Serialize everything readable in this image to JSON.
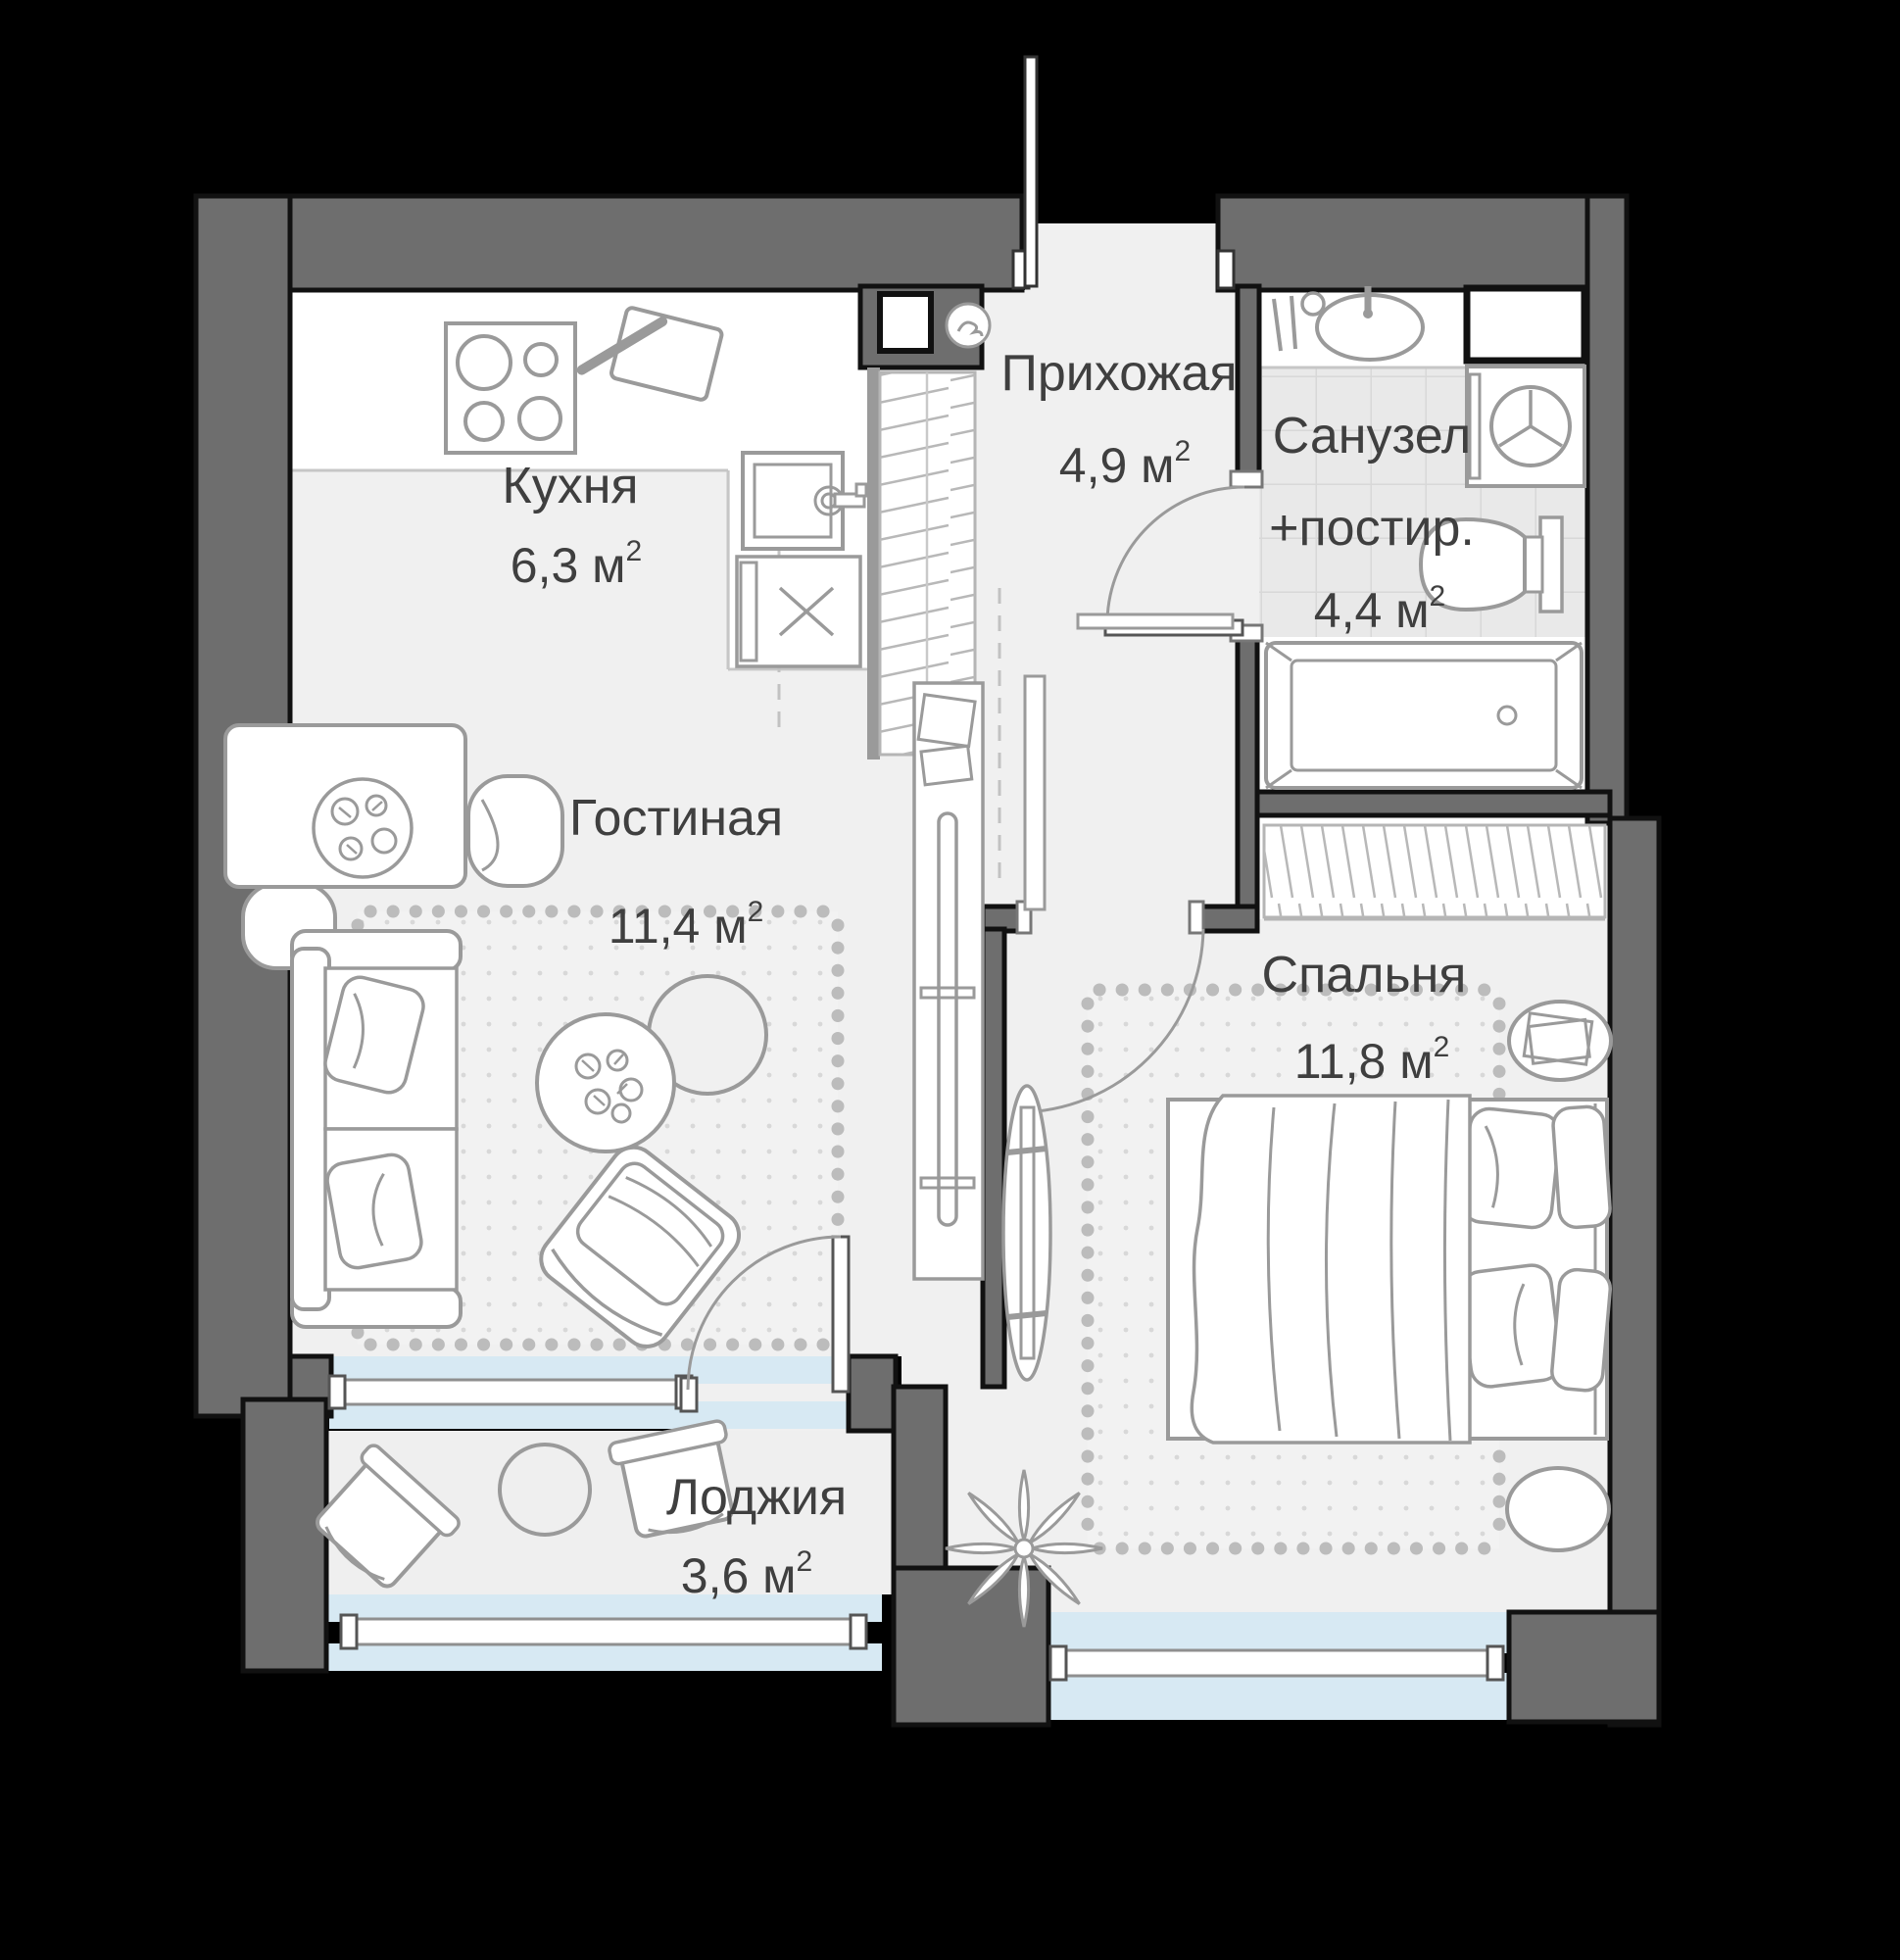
{
  "plan": {
    "title": "apartment-floor-plan",
    "language": "ru",
    "rooms": [
      {
        "id": "kitchen",
        "name": "Кухня",
        "area": "6,3 м",
        "sup": "2"
      },
      {
        "id": "hallway",
        "name": "Прихожая",
        "area": "4,9 м",
        "sup": "2"
      },
      {
        "id": "bathroom",
        "name": "Санузел",
        "name2": "+постир.",
        "area": "4,4 м",
        "sup": "2"
      },
      {
        "id": "living",
        "name": "Гостиная",
        "area": "11,4 м",
        "sup": "2"
      },
      {
        "id": "bedroom",
        "name": "Спальня",
        "area": "11,8 м",
        "sup": "2"
      },
      {
        "id": "loggia",
        "name": "Лоджия",
        "area": "3,6 м",
        "sup": "2"
      }
    ],
    "colors": {
      "background": "#000000",
      "wall": "#6e6e6e",
      "wall_outline": "#111111",
      "floor": "#f0f0f0",
      "white_zone": "#ffffff",
      "tile": "#e9e9e9",
      "window_glass": "#d7e9f3",
      "furniture_stroke": "#9a9a9a",
      "carpet_dot": "#d8d8d8",
      "text": "#3f3f3f"
    },
    "icons": [
      "stove-icon",
      "cutting-board-icon",
      "kitchen-sink-icon",
      "cabinet-icon",
      "vent-icon",
      "dining-table-icon",
      "chair-icon",
      "wardrobe-icon",
      "entrance-door-icon",
      "bathroom-sink-icon",
      "hygiene-icon",
      "washing-machine-icon",
      "toilet-icon",
      "bathtub-icon",
      "shaft-icon",
      "sofa-icon",
      "coffee-table-icon",
      "side-table-icon",
      "armchair-icon",
      "tv-console-icon",
      "bed-icon",
      "pillow-icon",
      "nightstand-icon",
      "mirror-icon",
      "plant-icon",
      "loggia-table-icon",
      "loggia-chair-icon",
      "window-icon",
      "door-arc-icon"
    ]
  }
}
